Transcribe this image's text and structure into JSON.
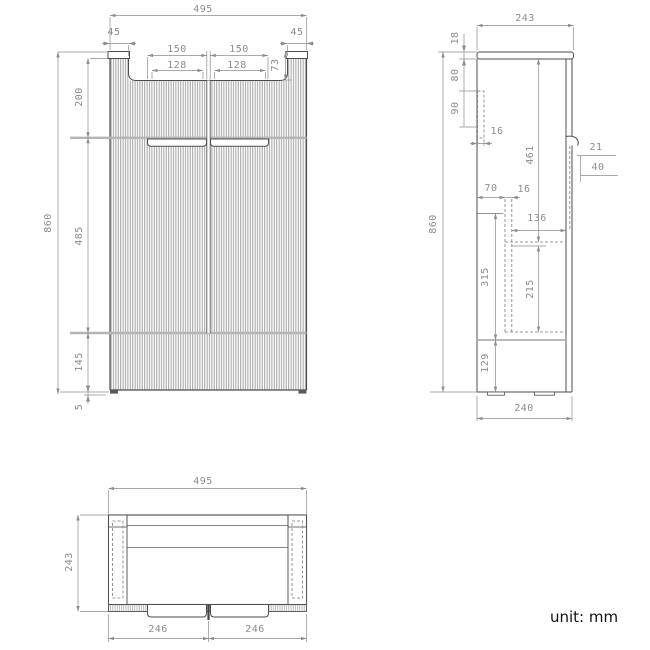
{
  "footer": {
    "unit_label": "unit: mm"
  },
  "views": {
    "front": {
      "dims": {
        "width_total": "495",
        "corner_left": "45",
        "corner_right": "45",
        "handle_outer_left": "150",
        "handle_outer_right": "150",
        "handle_inner_left": "128",
        "handle_inner_right": "128",
        "recess_depth": "73",
        "section_top": "200",
        "height_total": "860",
        "section_middle": "485",
        "section_bottom": "145",
        "foot_height": "5"
      }
    },
    "side": {
      "dims": {
        "depth_total": "243",
        "top_thickness": "18",
        "back_offset_top": "80",
        "rail_height": "90",
        "rail_thickness": "16",
        "interior_height": "461",
        "handle_depth": "21",
        "handle_height": "40",
        "back_clearance": "70",
        "panel_thickness": "16",
        "drawer_depth": "136",
        "height_total": "860",
        "lower_section": "315",
        "drawer_height": "215",
        "base_section": "129",
        "base_depth": "240"
      }
    },
    "plan": {
      "dims": {
        "width_total": "495",
        "depth_total": "243",
        "door_left": "246",
        "door_right": "246"
      }
    }
  }
}
